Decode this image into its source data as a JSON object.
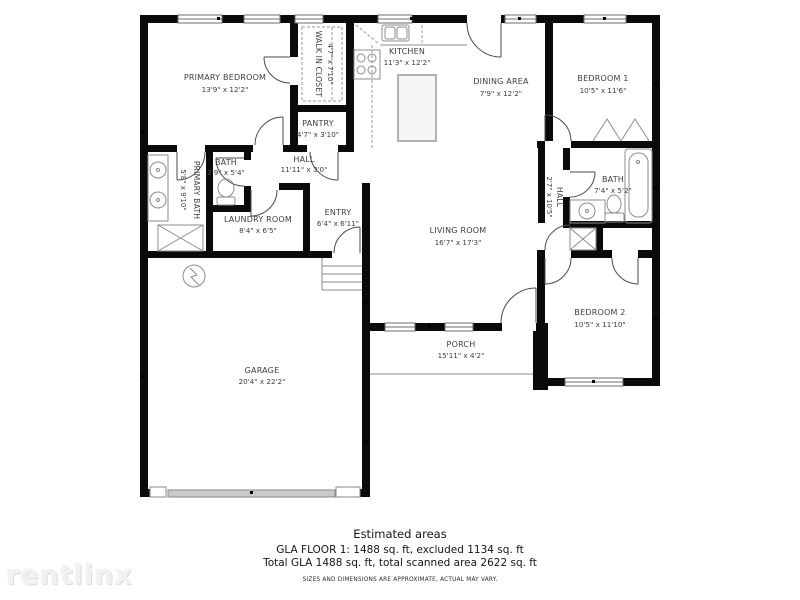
{
  "watermark": "rentlinx",
  "footer": {
    "title": "Estimated areas",
    "line1": "GLA FLOOR 1: 1488 sq. ft, excluded 1134 sq. ft",
    "line2": "Total GLA 1488 sq. ft, total scanned area 2622 sq. ft",
    "disclaimer": "SIZES AND DIMENSIONS ARE APPROXIMATE, ACTUAL MAY VARY."
  },
  "rooms": [
    {
      "name": "PRIMARY BEDROOM",
      "dims": "13'9\" x 12'2\""
    },
    {
      "name": "WALK IN CLOSET",
      "dims": "4'7\" x 7'10\""
    },
    {
      "name": "KITCHEN",
      "dims": "11'3\" x 12'2\""
    },
    {
      "name": "DINING AREA",
      "dims": "7'9\" x 12'2\""
    },
    {
      "name": "BEDROOM 1",
      "dims": "10'5\" x 11'6\""
    },
    {
      "name": "PANTRY",
      "dims": "4'7\" x 3'10\""
    },
    {
      "name": "HALL",
      "dims": "11'11\" x 3'0\""
    },
    {
      "name": "BATH",
      "dims": "2'9\" x 5'4\""
    },
    {
      "name": "PRIMARY BATH",
      "dims": "5'8\" x 9'10\""
    },
    {
      "name": "LAUNDRY ROOM",
      "dims": "8'4\" x 6'5\""
    },
    {
      "name": "ENTRY",
      "dims": "6'4\" x 6'11\""
    },
    {
      "name": "LIVING ROOM",
      "dims": "16'7\" x 17'3\""
    },
    {
      "name": "HALL",
      "dims": "2'7\" x 10'5\""
    },
    {
      "name": "BATH",
      "dims": "7'4\" x 5'2\""
    },
    {
      "name": "BEDROOM 2",
      "dims": "10'5\" x 11'10\""
    },
    {
      "name": "GARAGE",
      "dims": "20'4\" x 22'2\""
    },
    {
      "name": "PORCH",
      "dims": "15'11\" x 4'2\""
    }
  ]
}
